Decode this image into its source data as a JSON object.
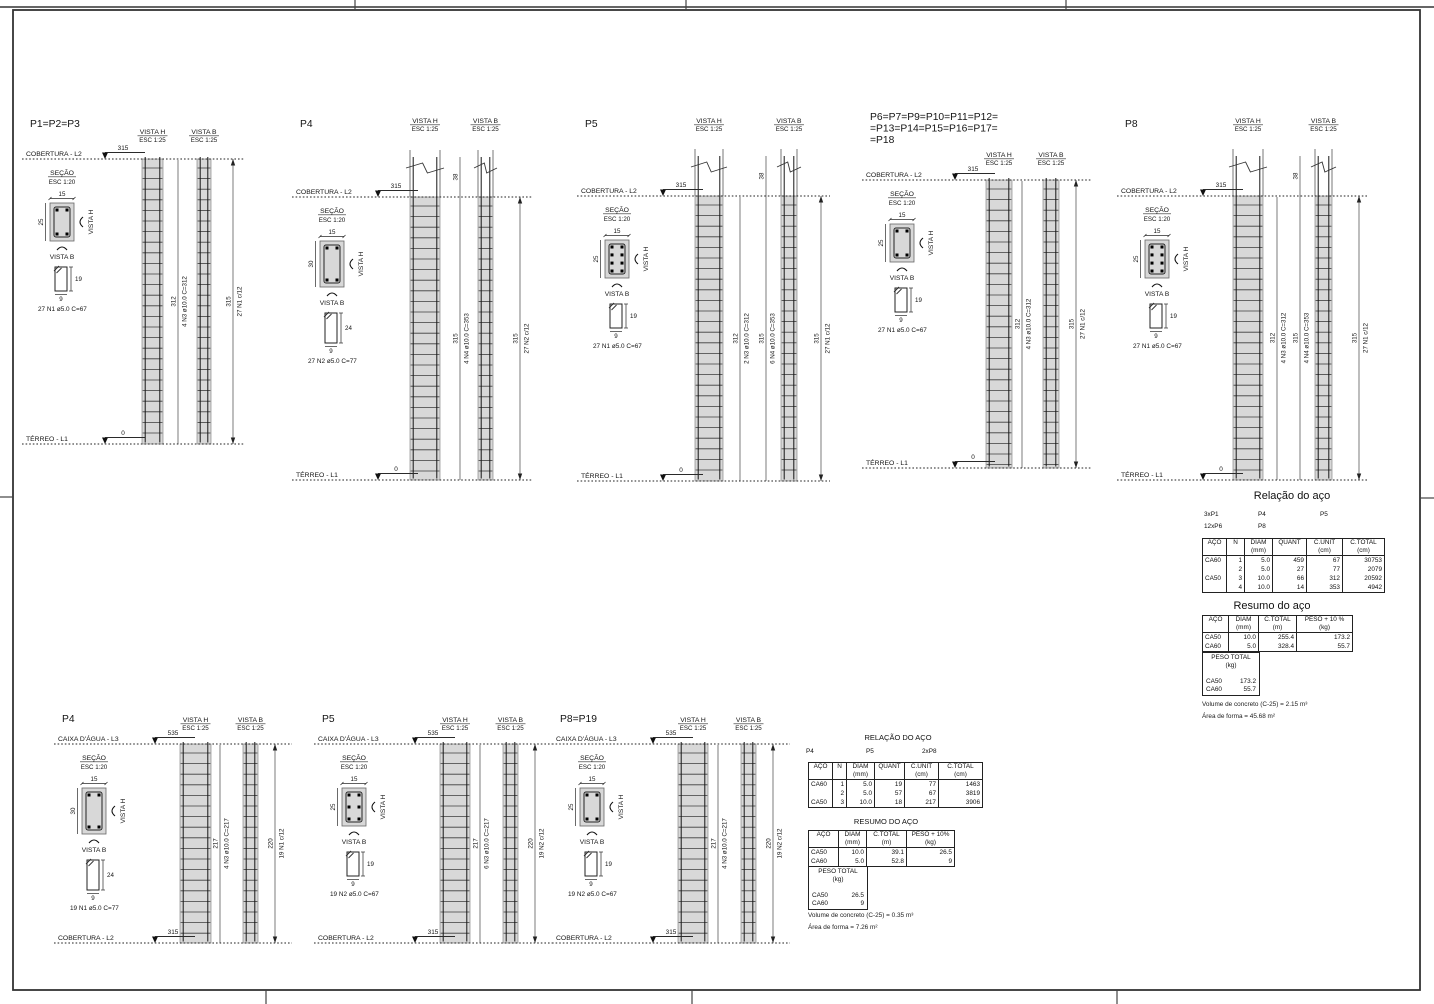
{
  "sheet": {
    "width": 1434,
    "height": 1004,
    "bg": "#ffffff",
    "line_color": "#2a2a2a",
    "hatch_fill": "#d8d8d8",
    "frame": {
      "x": 13,
      "y": 10,
      "w": 1407,
      "h": 980
    },
    "top_rule_y": 7,
    "ticks": {
      "top_x": [
        355,
        686,
        1066
      ],
      "bottom_x": [
        266,
        692,
        1117
      ],
      "left_y": 497,
      "right_y": 498
    }
  },
  "labels": {
    "vista_h": "VISTA H",
    "vista_b": "VISTA B",
    "esc_25": "ESC 1:25",
    "secao": "SEÇÃO",
    "esc_20": "ESC 1:20"
  },
  "pilars": [
    {
      "id": "P1",
      "x": 30,
      "w": 215,
      "title_y": 127,
      "label_y": 134,
      "top_y": 159,
      "bot_y": 444,
      "ext": false,
      "marker_x": 75,
      "title": [
        "P1=P2=P3"
      ],
      "top": {
        "label": "COBERTURA - L2",
        "dim": "315"
      },
      "bottom": {
        "label": "TÉRREO - L1",
        "dim": "0"
      },
      "col_h": {
        "x": 112,
        "w": 21
      },
      "col_b": {
        "x": 167,
        "w": 14
      },
      "dims": [
        {
          "x": 148,
          "t1": "312",
          "t2": "4 N3 ø10.0 C=312"
        },
        {
          "x": 203,
          "t1": "315",
          "t2": "27 N1 c/12",
          "arrows": true
        }
      ],
      "sec": {
        "w_label": "15",
        "h_label": "25",
        "h": 25,
        "bars": 4
      },
      "stir": {
        "h": 19,
        "h_label": "19",
        "w_label": "9",
        "label": "27 N1 ø5.0 C=67"
      }
    },
    {
      "id": "P4-terreo",
      "x": 300,
      "w": 232,
      "title_y": 127,
      "label_y": 123,
      "top_y": 197,
      "bot_y": 480,
      "ext": true,
      "marker_x": 78,
      "title": [
        "P4"
      ],
      "top": {
        "label": "COBERTURA - L2",
        "dim": "315"
      },
      "bottom": {
        "label": "TÉRREO - L1",
        "dim": "0"
      },
      "col_h": {
        "x": 110,
        "w": 30
      },
      "col_b": {
        "x": 178,
        "w": 15
      },
      "dims": [
        {
          "x": 160,
          "ext": true,
          "ext_label": "38",
          "t1": "315",
          "t2": "4 N4 ø10.0 C=353"
        },
        {
          "x": 220,
          "t1": "315",
          "t2": "27 N2 c/12",
          "arrows": true
        }
      ],
      "sec": {
        "w_label": "15",
        "h_label": "30",
        "h": 30,
        "bars": 4
      },
      "stir": {
        "h": 24,
        "h_label": "24",
        "w_label": "9",
        "label": "27 N2 ø5.0 C=77"
      }
    },
    {
      "id": "P5-terreo",
      "x": 585,
      "w": 245,
      "title_y": 127,
      "label_y": 123,
      "top_y": 196,
      "bot_y": 481,
      "ext": true,
      "marker_x": 78,
      "title": [
        "P5"
      ],
      "top": {
        "label": "COBERTURA - L2",
        "dim": "315"
      },
      "bottom": {
        "label": "TÉRREO - L1",
        "dim": "0"
      },
      "col_h": {
        "x": 110,
        "w": 28
      },
      "col_b": {
        "x": 196,
        "w": 16
      },
      "dims": [
        {
          "x": 155,
          "t1": "312",
          "t2": "2 N3 ø10.0 C=312"
        },
        {
          "x": 181,
          "ext": true,
          "ext_label": "38",
          "t1": "315",
          "t2": "6 N4 ø10.0 C=353"
        },
        {
          "x": 236,
          "t1": "315",
          "t2": "27 N1 c/12",
          "arrows": true
        }
      ],
      "sec": {
        "w_label": "15",
        "h_label": "25",
        "h": 25,
        "bars": 8
      },
      "stir": {
        "h": 19,
        "h_label": "19",
        "w_label": "9",
        "label": "27 N1 ø5.0 C=67"
      }
    },
    {
      "id": "P6-group",
      "x": 870,
      "w": 222,
      "title_y": 120,
      "label_y": 157,
      "top_y": 180,
      "bot_y": 468,
      "ext": false,
      "marker_x": 85,
      "title": [
        "P6=P7=P9=P10=P11=P12=",
        "=P13=P14=P15=P16=P17=",
        "=P18"
      ],
      "top": {
        "label": "COBERTURA - L2",
        "dim": "315"
      },
      "bottom": {
        "label": "TÉRREO - L1",
        "dim": "0"
      },
      "col_h": {
        "x": 116,
        "w": 26
      },
      "col_b": {
        "x": 173,
        "w": 16
      },
      "dims": [
        {
          "x": 152,
          "t1": "312",
          "t2": "4 N3 ø10.0 C=312"
        },
        {
          "x": 206,
          "t1": "315",
          "t2": "27 N1 c/12",
          "arrows": true
        }
      ],
      "sec": {
        "w_label": "15",
        "h_label": "25",
        "h": 25,
        "bars": 4
      },
      "stir": {
        "h": 19,
        "h_label": "19",
        "w_label": "9",
        "label": "27 N1 ø5.0 C=67"
      }
    },
    {
      "id": "P8-terreo",
      "x": 1125,
      "w": 242,
      "title_y": 127,
      "label_y": 123,
      "top_y": 196,
      "bot_y": 480,
      "ext": true,
      "marker_x": 78,
      "title": [
        "P8"
      ],
      "top": {
        "label": "COBERTURA - L2",
        "dim": "315"
      },
      "bottom": {
        "label": "TÉRREO - L1",
        "dim": "0"
      },
      "col_h": {
        "x": 108,
        "w": 30
      },
      "col_b": {
        "x": 190,
        "w": 17
      },
      "dims": [
        {
          "x": 152,
          "t1": "312",
          "t2": "4 N3 ø10.0 C=312"
        },
        {
          "x": 175,
          "ext": true,
          "ext_label": "38",
          "t1": "315",
          "t2": "4 N4 ø10.0 C=353"
        },
        {
          "x": 234,
          "t1": "315",
          "t2": "27 N1 c/12",
          "arrows": true
        }
      ],
      "sec": {
        "w_label": "15",
        "h_label": "25",
        "h": 25,
        "bars": 8
      },
      "stir": {
        "h": 19,
        "h_label": "19",
        "w_label": "9",
        "label": "27 N1 ø5.0 C=67"
      }
    },
    {
      "id": "P4-cobertura",
      "x": 62,
      "w": 230,
      "title_y": 722,
      "label_y": 722,
      "top_y": 744,
      "bot_y": 943,
      "ext": false,
      "marker_x": 93,
      "title": [
        "P4"
      ],
      "top": {
        "label": "CAIXA D'ÁGUA - L3",
        "dim": "535"
      },
      "bottom": {
        "label": "COBERTURA - L2",
        "dim": "315"
      },
      "col_h": {
        "x": 118,
        "w": 31
      },
      "col_b": {
        "x": 181,
        "w": 15
      },
      "dims": [
        {
          "x": 158,
          "t1": "217",
          "t2": "4 N3 ø10.0 C=217"
        },
        {
          "x": 213,
          "t1": "220",
          "t2": "19 N1 c/12",
          "arrows": true
        }
      ],
      "sec": {
        "w_label": "15",
        "h_label": "30",
        "h": 30,
        "bars": 4
      },
      "stir": {
        "h": 24,
        "h_label": "24",
        "w_label": "9",
        "label": "19 N1 ø5.0 C=77"
      }
    },
    {
      "id": "P5-cobertura",
      "x": 322,
      "w": 230,
      "title_y": 722,
      "label_y": 722,
      "top_y": 744,
      "bot_y": 943,
      "ext": false,
      "marker_x": 93,
      "title": [
        "P5"
      ],
      "top": {
        "label": "CAIXA D'ÁGUA - L3",
        "dim": "535"
      },
      "bottom": {
        "label": "COBERTURA - L2",
        "dim": "315"
      },
      "col_h": {
        "x": 118,
        "w": 30
      },
      "col_b": {
        "x": 181,
        "w": 15
      },
      "dims": [
        {
          "x": 158,
          "t1": "217",
          "t2": "6 N3 ø10.0 C=217"
        },
        {
          "x": 213,
          "t1": "220",
          "t2": "19 N2 c/12",
          "arrows": true
        }
      ],
      "sec": {
        "w_label": "15",
        "h_label": "25",
        "h": 25,
        "bars": 6
      },
      "stir": {
        "h": 19,
        "h_label": "19",
        "w_label": "9",
        "label": "19 N2 ø5.0 C=67"
      }
    },
    {
      "id": "P8-P19-cobertura",
      "x": 560,
      "w": 230,
      "title_y": 722,
      "label_y": 722,
      "top_y": 744,
      "bot_y": 943,
      "ext": false,
      "marker_x": 93,
      "title": [
        "P8=P19"
      ],
      "top": {
        "label": "CAIXA D'ÁGUA - L3",
        "dim": "535"
      },
      "bottom": {
        "label": "COBERTURA - L2",
        "dim": "315"
      },
      "col_h": {
        "x": 118,
        "w": 30
      },
      "col_b": {
        "x": 181,
        "w": 15
      },
      "dims": [
        {
          "x": 158,
          "t1": "217",
          "t2": "4 N3 ø10.0 C=217"
        },
        {
          "x": 213,
          "t1": "220",
          "t2": "19 N2 c/12",
          "arrows": true
        }
      ],
      "sec": {
        "w_label": "15",
        "h_label": "25",
        "h": 25,
        "bars": 4
      },
      "stir": {
        "h": 19,
        "h_label": "19",
        "w_label": "9",
        "label": "19 N2 ø5.0 C=67"
      }
    }
  ],
  "steel_tables": {
    "rel_top": {
      "title": "Relação do aço",
      "title_x": 1292,
      "title_y": 490,
      "title_fs": 11,
      "groups": [
        {
          "x": 1204,
          "y": 511,
          "text": "3xP1"
        },
        {
          "x": 1258,
          "y": 511,
          "text": "P4"
        },
        {
          "x": 1320,
          "y": 511,
          "text": "P5"
        },
        {
          "x": 1204,
          "y": 523,
          "text": "12xP6"
        },
        {
          "x": 1258,
          "y": 523,
          "text": "P8"
        }
      ],
      "x": 1202,
      "y": 538,
      "widths": [
        24,
        18,
        28,
        34,
        36,
        42
      ],
      "aligns": [
        "l",
        "r",
        "r",
        "r",
        "r",
        "r"
      ],
      "headers": [
        [
          "AÇO",
          ""
        ],
        [
          "N",
          ""
        ],
        [
          "DIAM",
          "(mm)"
        ],
        [
          "QUANT",
          ""
        ],
        [
          "C.UNIT",
          "(cm)"
        ],
        [
          "C.TOTAL",
          "(cm)"
        ]
      ],
      "rows": [
        [
          "CA60",
          "1",
          "5.0",
          "459",
          "67",
          "30753"
        ],
        [
          "",
          "2",
          "5.0",
          "27",
          "77",
          "2079"
        ],
        [
          "CA50",
          "3",
          "10.0",
          "66",
          "312",
          "20592"
        ],
        [
          "",
          "4",
          "10.0",
          "14",
          "353",
          "4942"
        ]
      ]
    },
    "res_top": {
      "title": "Resumo do aço",
      "title_x": 1272,
      "title_y": 600,
      "title_fs": 11,
      "x": 1202,
      "y": 615,
      "widths": [
        26,
        30,
        38,
        56
      ],
      "aligns": [
        "l",
        "r",
        "r",
        "r"
      ],
      "headers": [
        [
          "AÇO",
          ""
        ],
        [
          "DIAM",
          "(mm)"
        ],
        [
          "C.TOTAL",
          "(m)"
        ],
        [
          "PESO + 10 %",
          "(kg)"
        ]
      ],
      "rows": [
        [
          "CA50",
          "10.0",
          "255.4",
          "173.2"
        ],
        [
          "CA60",
          "5.0",
          "328.4",
          "55.7"
        ]
      ],
      "peso": {
        "x": 1202,
        "y": 652,
        "w": 58,
        "title": "PESO TOTAL",
        "unit": "(kg)",
        "rows": [
          [
            "CA50",
            "173.2"
          ],
          [
            "CA60",
            "55.7"
          ]
        ]
      },
      "notes": [
        "Volume de concreto (C-25) = 2.15 m³",
        "Área de forma = 45.68 m²"
      ],
      "notes_x": 1202,
      "notes_y": 701
    },
    "rel_bot": {
      "title": "RELAÇÃO DO AÇO",
      "title_x": 898,
      "title_y": 733,
      "title_fs": 7.5,
      "groups": [
        {
          "x": 806,
          "y": 748,
          "text": "P4"
        },
        {
          "x": 866,
          "y": 748,
          "text": "P5"
        },
        {
          "x": 922,
          "y": 748,
          "text": "2xP8"
        }
      ],
      "x": 808,
      "y": 762,
      "widths": [
        24,
        14,
        28,
        30,
        34,
        44
      ],
      "aligns": [
        "l",
        "r",
        "r",
        "r",
        "r",
        "r"
      ],
      "headers": [
        [
          "AÇO",
          ""
        ],
        [
          "N",
          ""
        ],
        [
          "DIAM",
          "(mm)"
        ],
        [
          "QUANT",
          ""
        ],
        [
          "C.UNIT",
          "(cm)"
        ],
        [
          "C.TOTAL",
          "(cm)"
        ]
      ],
      "rows": [
        [
          "CA60",
          "1",
          "5.0",
          "19",
          "77",
          "1463"
        ],
        [
          "",
          "2",
          "5.0",
          "57",
          "67",
          "3819"
        ],
        [
          "CA50",
          "3",
          "10.0",
          "18",
          "217",
          "3906"
        ]
      ]
    },
    "res_bot": {
      "title": "RESUMO DO AÇO",
      "title_x": 886,
      "title_y": 817,
      "title_fs": 7.5,
      "x": 808,
      "y": 830,
      "widths": [
        30,
        28,
        40,
        48
      ],
      "aligns": [
        "l",
        "r",
        "r",
        "r"
      ],
      "headers": [
        [
          "AÇO",
          ""
        ],
        [
          "DIAM",
          "(mm)"
        ],
        [
          "C.TOTAL",
          "(m)"
        ],
        [
          "PESO + 10%",
          "(kg)"
        ]
      ],
      "rows": [
        [
          "CA50",
          "10.0",
          "39.1",
          "26.5"
        ],
        [
          "CA60",
          "5.0",
          "52.8",
          "9"
        ]
      ],
      "peso": {
        "x": 808,
        "y": 866,
        "w": 60,
        "title": "PESO TOTAL",
        "unit": "(kg)",
        "rows": [
          [
            "CA50",
            "26.5"
          ],
          [
            "CA60",
            "9"
          ]
        ]
      },
      "notes": [
        "Volume de concreto (C-25) = 0.35 m³",
        "Área de forma = 7.26 m²"
      ],
      "notes_x": 808,
      "notes_y": 912
    }
  }
}
